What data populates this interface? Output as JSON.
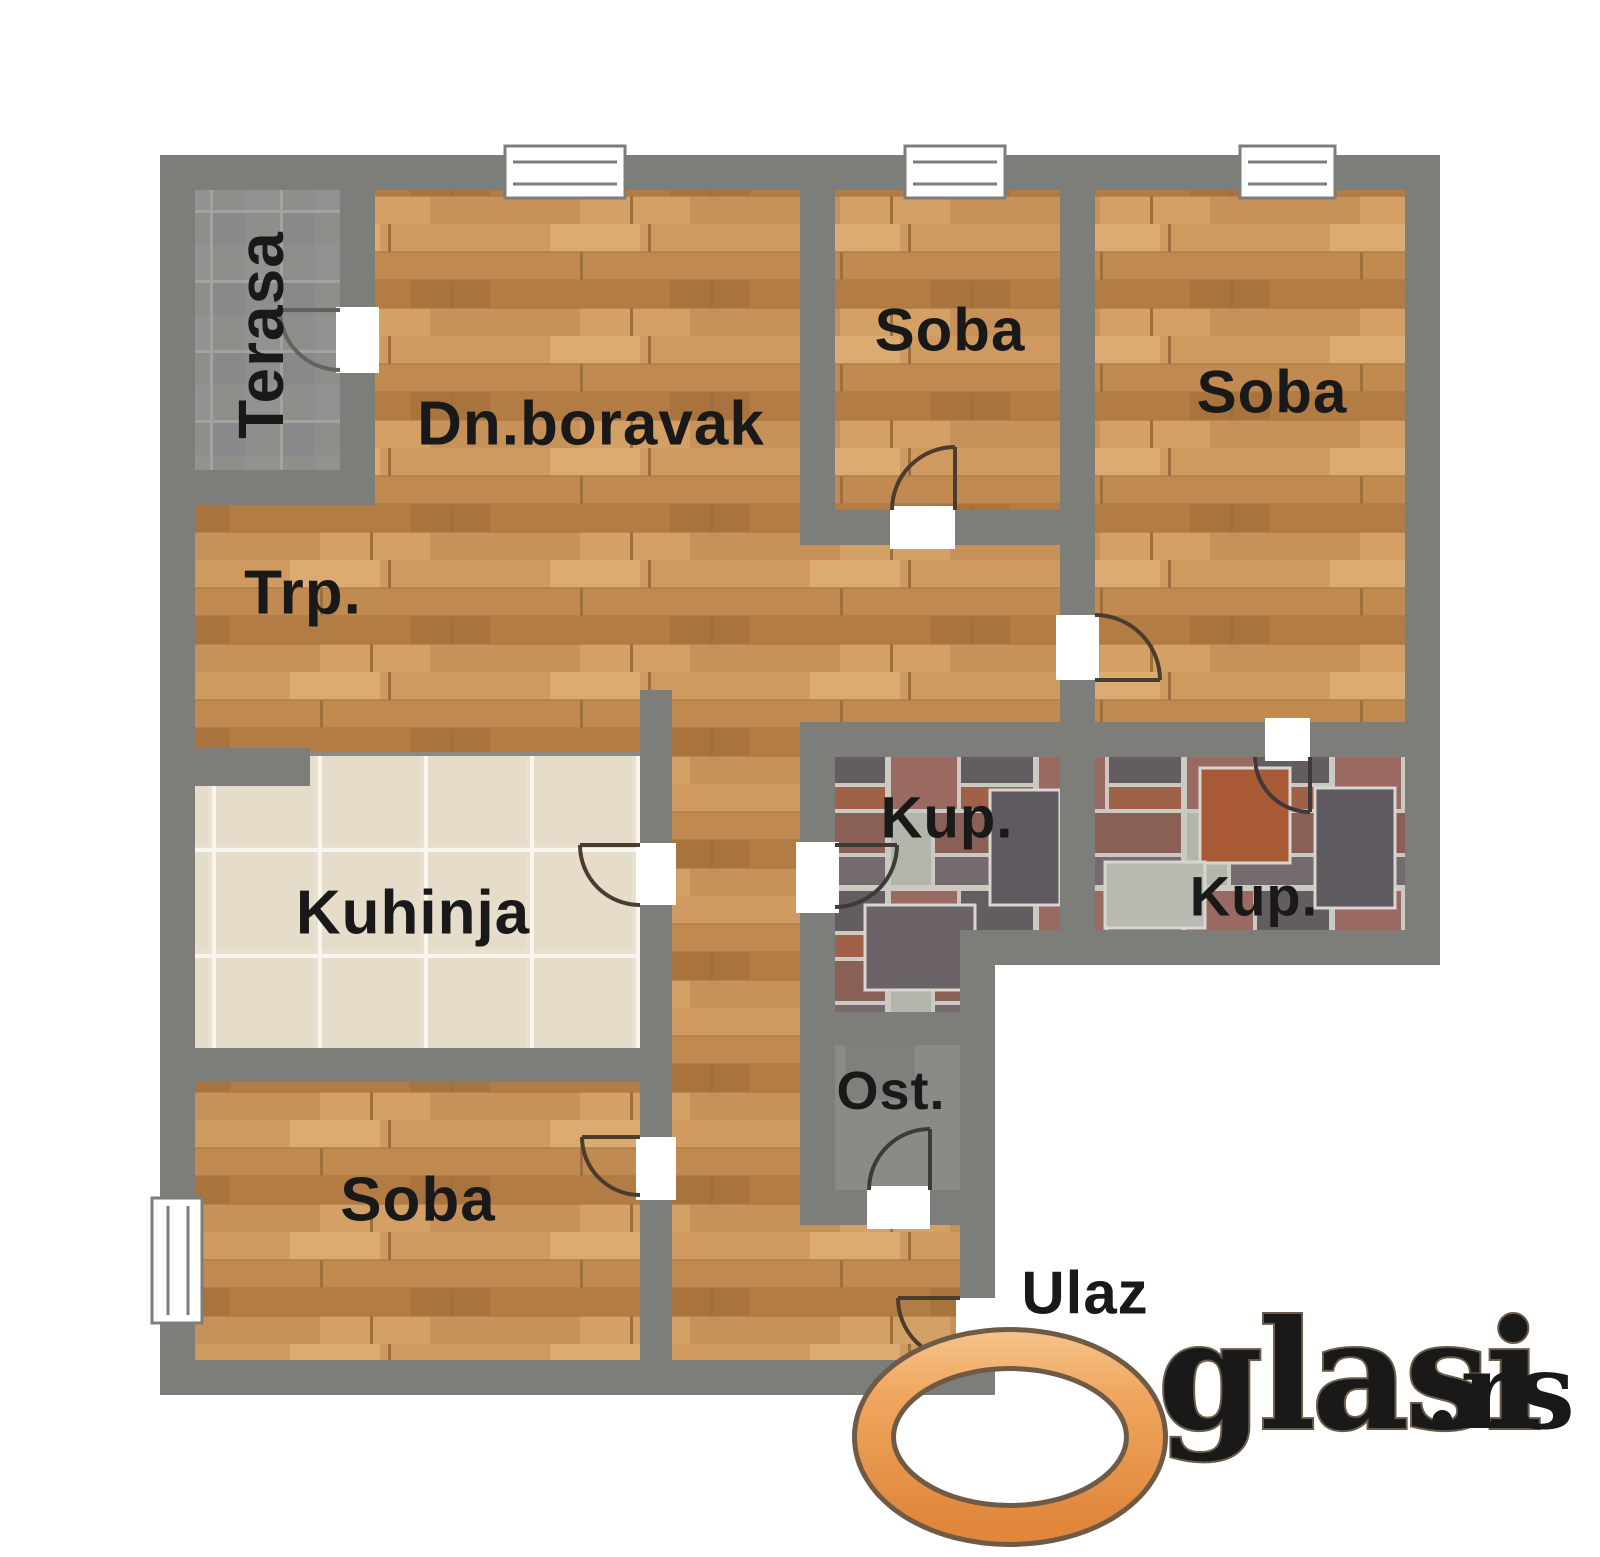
{
  "plan": {
    "rooms": {
      "terasa": {
        "label": "Terasa"
      },
      "living": {
        "label": "Dn.boravak"
      },
      "dining": {
        "label": "Trp."
      },
      "soba_top": {
        "label": "Soba"
      },
      "soba_right": {
        "label": "Soba"
      },
      "soba_bottom": {
        "label": "Soba"
      },
      "kitchen": {
        "label": "Kuhinja"
      },
      "bath_left": {
        "label": "Kup."
      },
      "bath_right": {
        "label": "Kup."
      },
      "pantry": {
        "label": "Ost."
      },
      "entrance": {
        "label": "Ulaz"
      }
    },
    "colors": {
      "wall": "#7d7d7a",
      "wood_floor": "#c58e54",
      "kitchen_tile": "#e9e0cf",
      "terrace_tile": "#8e8e8b",
      "bath_mosaic": "#9a6a62",
      "label_text": "#191919"
    }
  },
  "watermark": {
    "brand": "Oglasi",
    "brand_tail": "glasi",
    "suffix": ".rs",
    "brand_color": "#f0a75f",
    "suffix_color": "#9f9f9f"
  }
}
